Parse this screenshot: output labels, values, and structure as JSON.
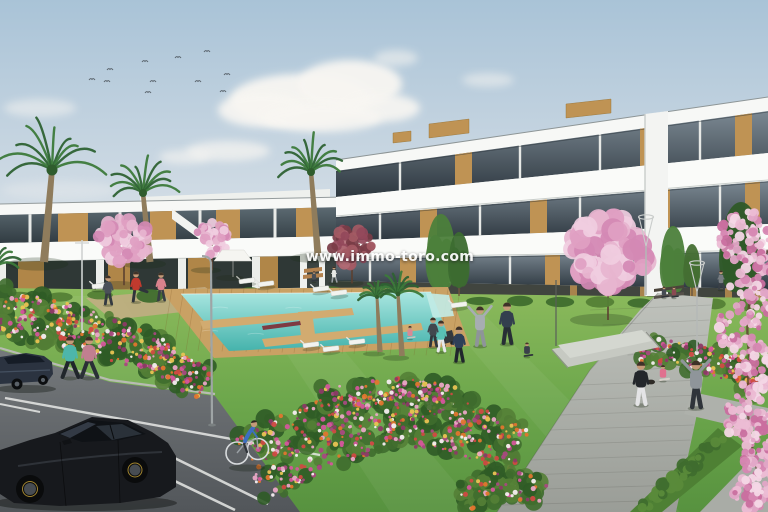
{
  "watermark": {
    "text": "www.immo-toro.com"
  },
  "scene": {
    "type": "architectural-render",
    "description": "New-build white apartment complex with communal swimming pool, lawns, flower beds, palm and blossom trees, pedestrian paths and a parking area with cars, joggers, a cyclist and people exercising on the grass."
  },
  "palette": {
    "sky_top": "#a9c3d7",
    "sky_horizon": "#e9eef0",
    "cloud": "#f8f6f2",
    "building_white": "#f2f4f1",
    "building_shadow": "#d9dcd8",
    "glass_dark": "#37424b",
    "wood_accent": "#bf9354",
    "lawn_light": "#8cba5c",
    "lawn_dark": "#57923f",
    "pool_light": "#a9e6e0",
    "pool_dark": "#45b3ac",
    "deck_wood": "#c9a164",
    "path_gray": "#b4b7b1",
    "asphalt": "#63676a",
    "flower_pink": "#d4569b",
    "flower_orange": "#e0762e",
    "flower_yellow": "#e9c353",
    "blossom_pink": "#e7b5cf",
    "blossom_maroon": "#92485a",
    "palm_green": "#3c7a3a",
    "hedge_green": "#4e8034",
    "skin": "#c49a78"
  }
}
